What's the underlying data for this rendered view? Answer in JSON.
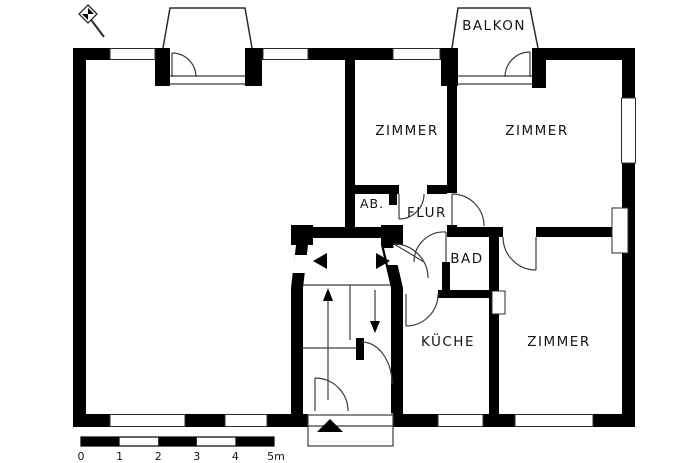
{
  "plan": {
    "title": "apartment-floor-plan",
    "rooms": {
      "balkon": {
        "label": "BALKON"
      },
      "zimmer_top_middle": {
        "label": "ZIMMER"
      },
      "zimmer_top_right": {
        "label": "ZIMMER"
      },
      "ab": {
        "label": "AB."
      },
      "flur": {
        "label": "FLUR"
      },
      "bad": {
        "label": "BAD"
      },
      "kueche": {
        "label": "KÜCHE"
      },
      "zimmer_bottom_right": {
        "label": "ZIMMER"
      }
    },
    "scale_bar": {
      "unit_labels": [
        "0",
        "1",
        "2",
        "3",
        "4",
        "5m"
      ]
    },
    "colors": {
      "wall": "#000000",
      "thin_line": "#3c3c3c",
      "text": "#151515",
      "background": "#ffffff"
    }
  }
}
